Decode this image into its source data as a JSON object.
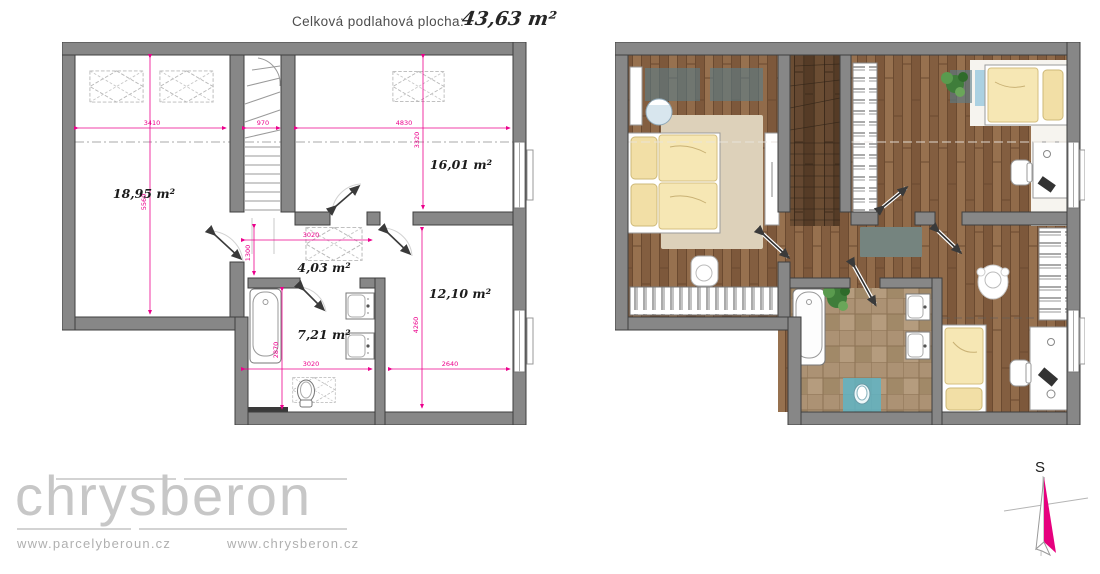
{
  "header": {
    "label": "Celková podlahová plocha:",
    "value": "43,63 m²"
  },
  "left_plan": {
    "rooms": [
      {
        "label": "18,95 m²"
      },
      {
        "label": "16,01 m²"
      },
      {
        "label": "4,03 m²"
      },
      {
        "label": "7,21 m²"
      },
      {
        "label": "12,10 m²"
      }
    ],
    "dims": {
      "room1_w": "3410",
      "stairs_w": "970",
      "room2_w": "4830",
      "room1_h": "5560",
      "room2_h": "3320",
      "hall_w": "3020",
      "hall_h": "1300",
      "bath_w": "3020",
      "bath_h": "2870",
      "room3_w": "2640",
      "room3_h": "4260"
    }
  },
  "footer": {
    "logo": "chrysberon",
    "url_left": "www.parcelyberoun.cz",
    "url_right": "www.chrysberon.cz"
  },
  "compass": {
    "north_label": "S"
  },
  "colors": {
    "dimension_pink": "#ec008c",
    "wall_gray": "#878787",
    "wood_brown": "#8a6444",
    "tile_tan": "#ac9274",
    "skylight_blue": "#6f98a8",
    "bedding_yellow": "#f5e5b0",
    "logo_gray": "#c7c7c7"
  }
}
